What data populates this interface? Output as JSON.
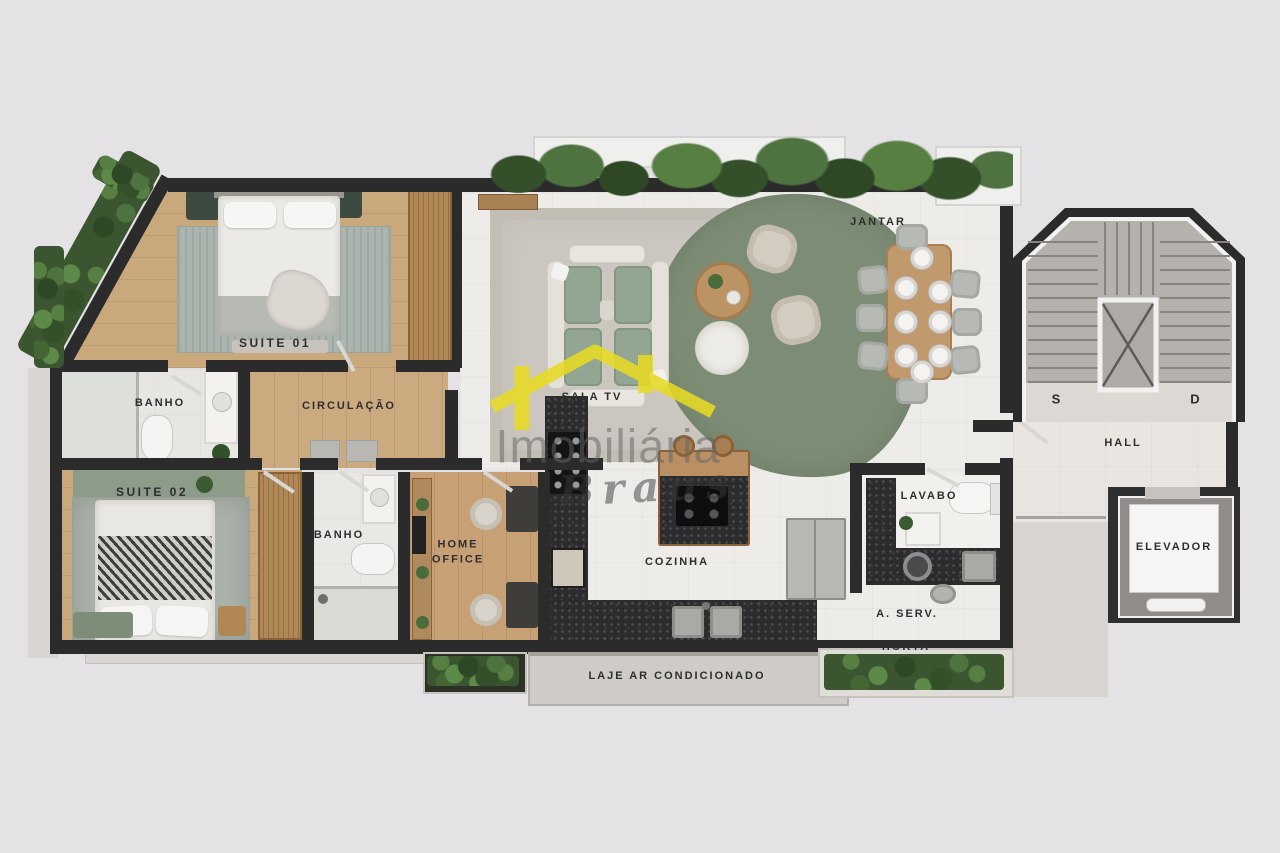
{
  "rooms": {
    "suite01": "SUITE 01",
    "banho1": "BANHO",
    "circulacao": "CIRCULAÇÃO",
    "suite02": "SUITE 02",
    "banho2": "BANHO",
    "home_office": "HOME OFFICE",
    "sala_tv": "SALA TV",
    "jantar": "JANTAR",
    "cozinha": "COZINHA",
    "lavabo": "LAVABO",
    "area_servico": "A. SERV.",
    "horta": "HORTA",
    "laje": "LAJE AR CONDICIONADO",
    "hall": "HALL",
    "elevador": "ELEVADOR",
    "stair_s": "S",
    "stair_d": "D"
  },
  "watermark": {
    "line1": "Imobiliária",
    "line2": "Braus",
    "roof_color": "#e8db25",
    "text_color": "#6f6f6f"
  },
  "colors": {
    "background": "#e5e2e5",
    "wall": "#2b2b2c",
    "wood_floor": "#c7a076",
    "tile_floor": "#edece8",
    "green_rug": "#7d8d75",
    "hedge_green": "#3b5531",
    "granite_counter": "#2c2c2e",
    "stair_gray": "#b5b2ae",
    "accent_yellow": "#e8db25"
  }
}
